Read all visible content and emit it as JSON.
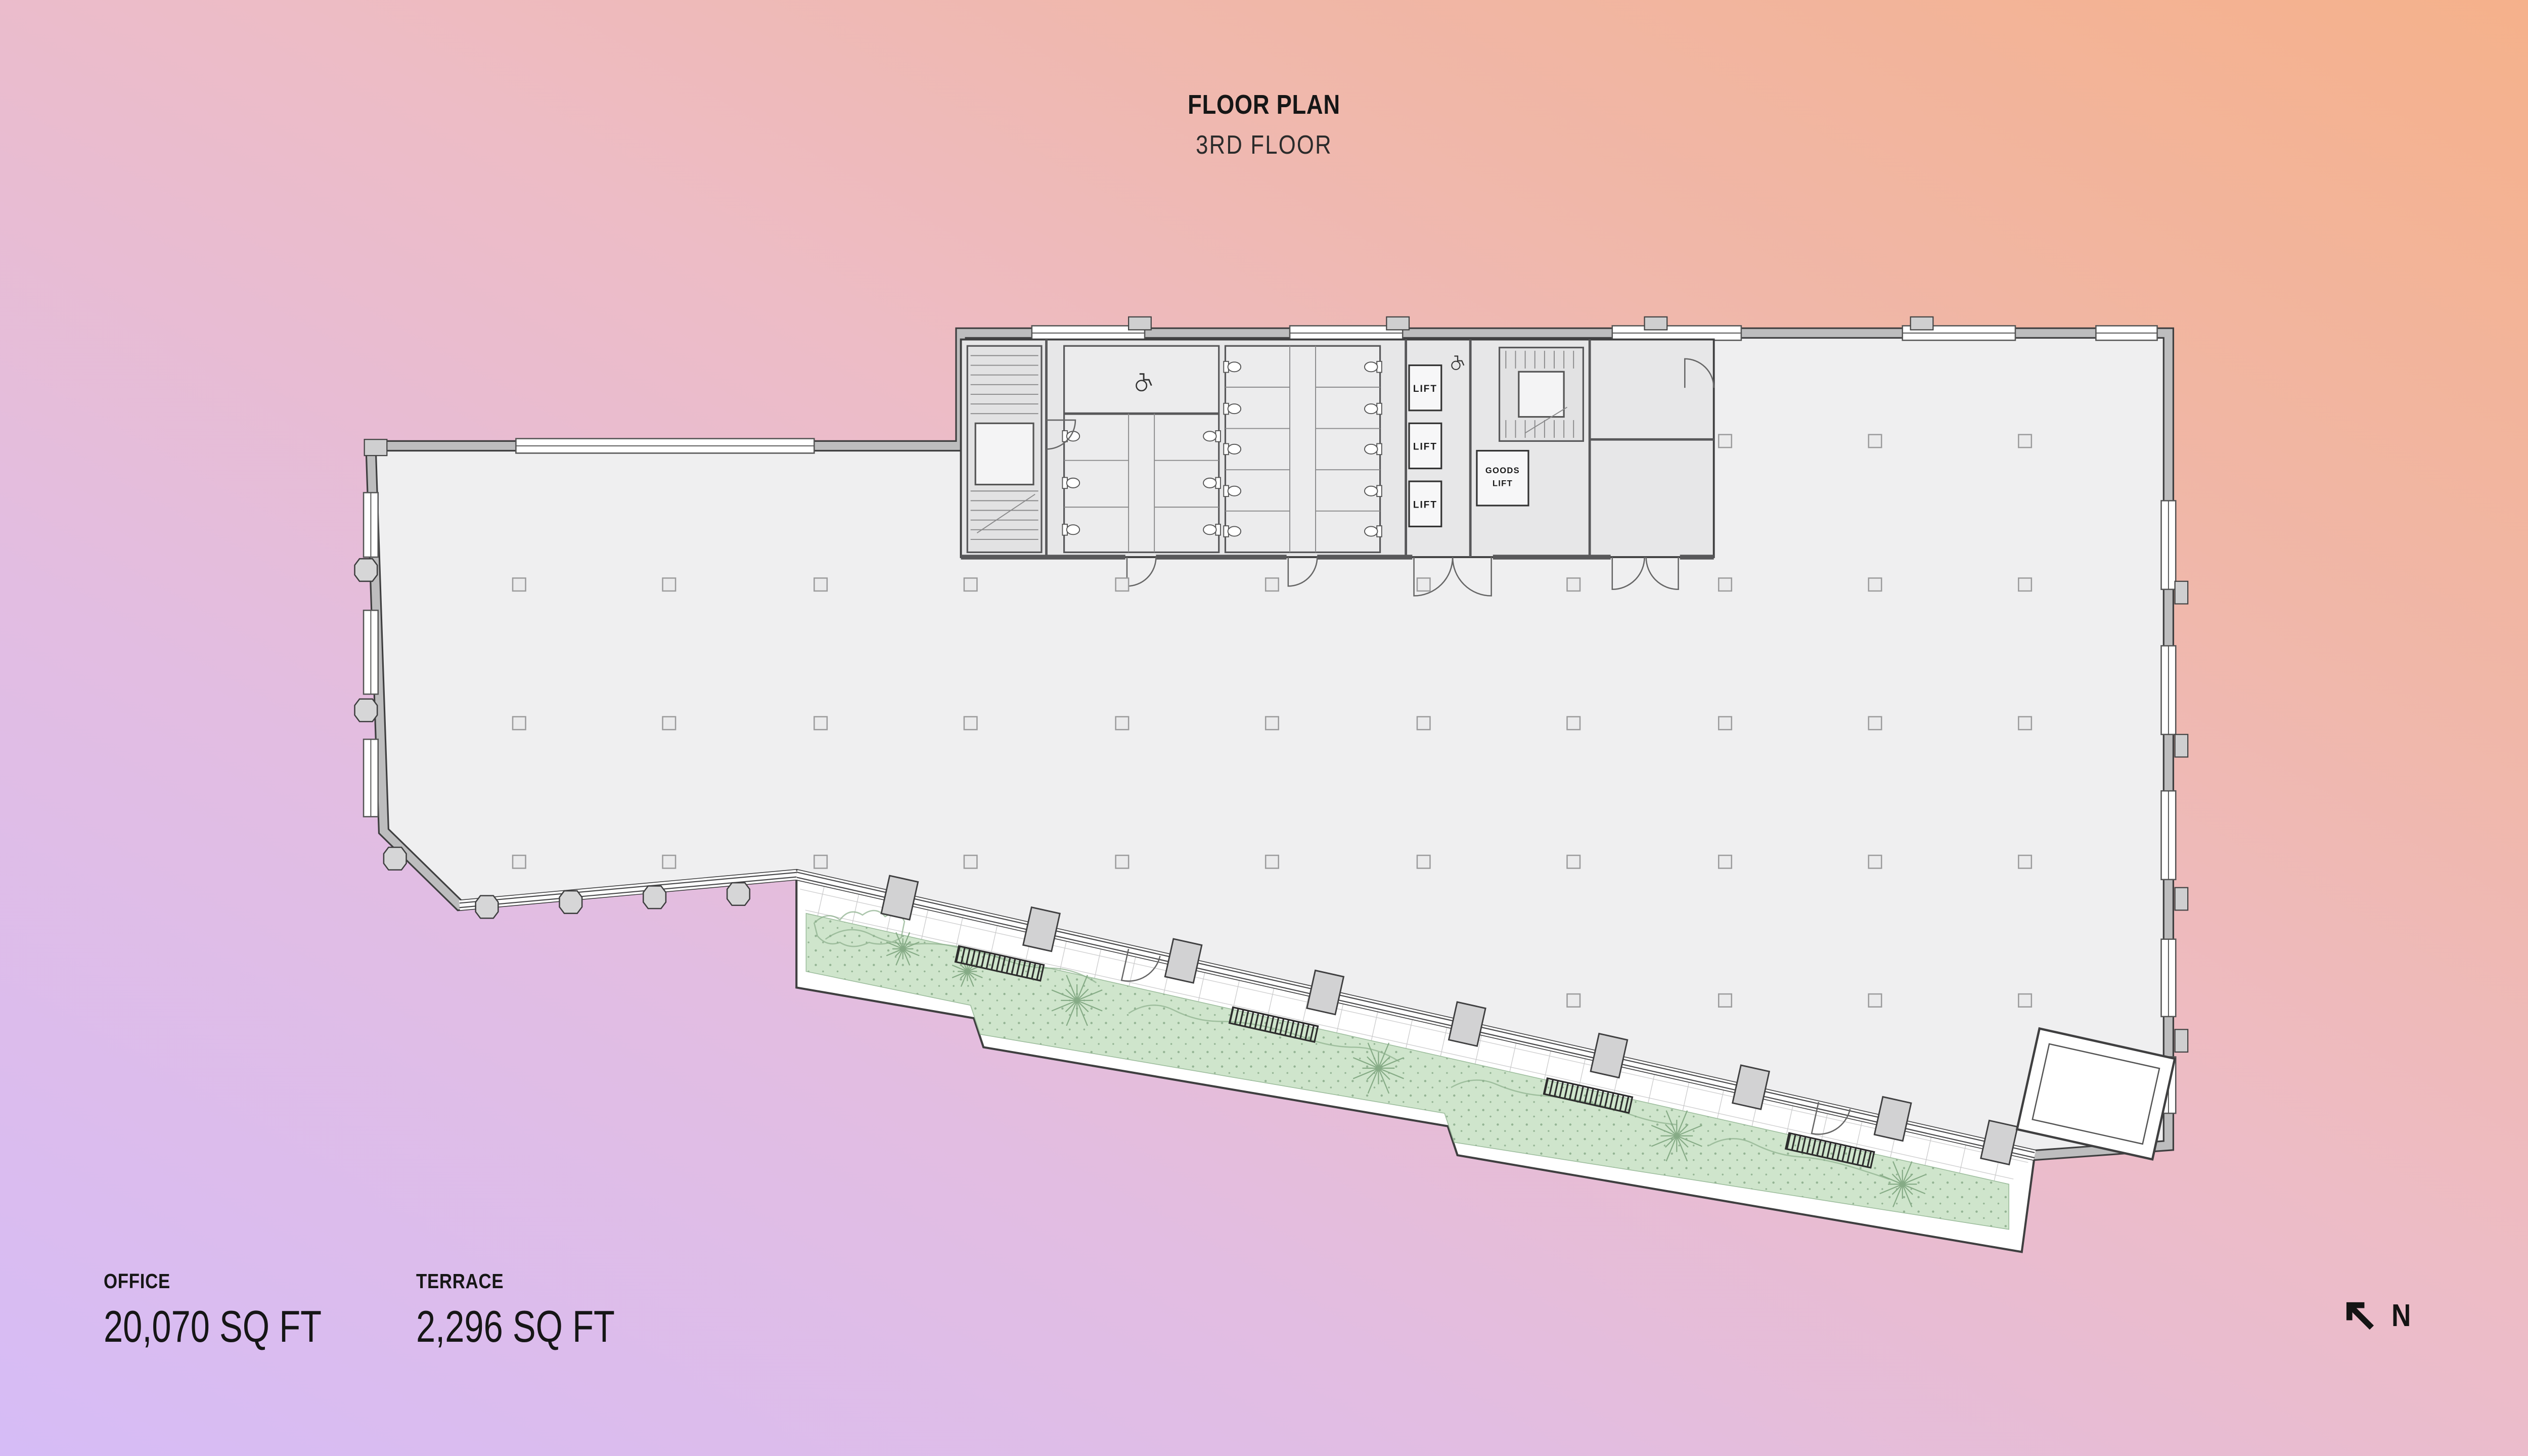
{
  "title": {
    "heading": "FLOOR PLAN",
    "subheading": "3RD FLOOR"
  },
  "stats": [
    {
      "label": "OFFICE",
      "value": "20,070 SQ FT"
    },
    {
      "label": "TERRACE",
      "value": "2,296 SQ FT"
    }
  ],
  "compass": {
    "label": "N",
    "direction": "up-left"
  },
  "plan": {
    "lifts": [
      "LIFT",
      "LIFT",
      "LIFT"
    ],
    "goods_lift": {
      "line1": "GOODS",
      "line2": "LIFT"
    },
    "colors": {
      "background_bottom_left": "#d6bcf6",
      "background_middle": "#edbcc6",
      "background_top_right": "#f5b18b",
      "floor": "#efeff0",
      "core": "#e7e7e8",
      "wall": "#bdbdbe",
      "wall_outline": "#3f3f40",
      "terrace_planting": "#cfe5cc",
      "tile_line": "#c9c9ca"
    }
  }
}
